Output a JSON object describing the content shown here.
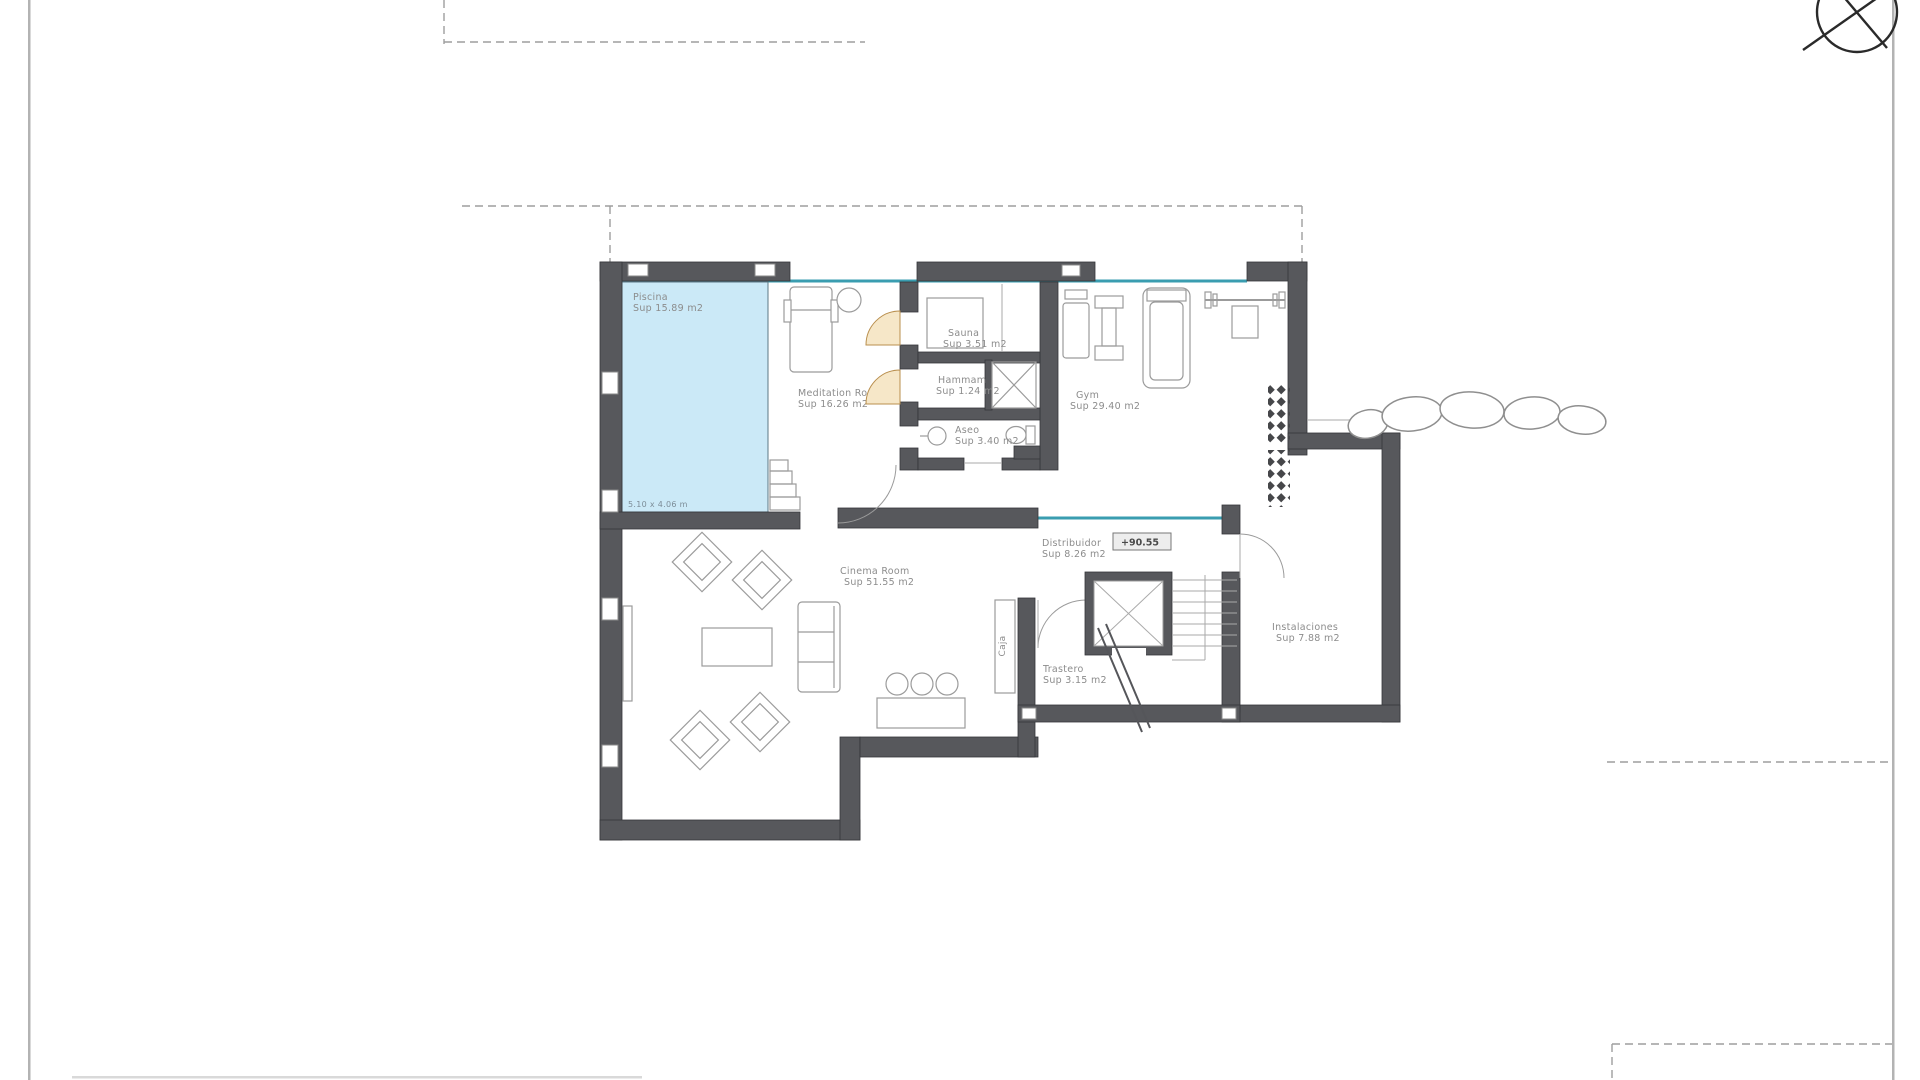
{
  "plan": {
    "rooms": {
      "piscina": {
        "name": "Piscina",
        "area": "Sup 15.89 m2",
        "dimensions": "5.10 x 4.06 m"
      },
      "meditation": {
        "name": "Meditation Room",
        "area": "Sup 16.26 m2"
      },
      "sauna": {
        "name": "Sauna",
        "area": "Sup 3.51 m2"
      },
      "hammam": {
        "name": "Hammam",
        "area": "Sup 1.24 m2"
      },
      "aseo": {
        "name": "Aseo",
        "area": "Sup 3.40 m2"
      },
      "gym": {
        "name": "Gym",
        "area": "Sup 29.40 m2"
      },
      "distribuidor": {
        "name": "Distribuidor",
        "area": "Sup 8.26 m2"
      },
      "cinema": {
        "name": "Cinema Room",
        "area": "Sup 51.55 m2"
      },
      "trastero": {
        "name": "Trastero",
        "area": "Sup 3.15 m2"
      },
      "instalaciones": {
        "name": "Instalaciones",
        "area": "Sup 7.88 m2"
      },
      "caja": {
        "name": "Caja"
      }
    },
    "level_marker": "+90.55",
    "colors": {
      "wall": "#57585c",
      "pool_water": "#cbe9f7",
      "glazing": "#3a9db0",
      "door_leaf": "#f6e7c8",
      "label_text": "#8c8c8c"
    }
  }
}
